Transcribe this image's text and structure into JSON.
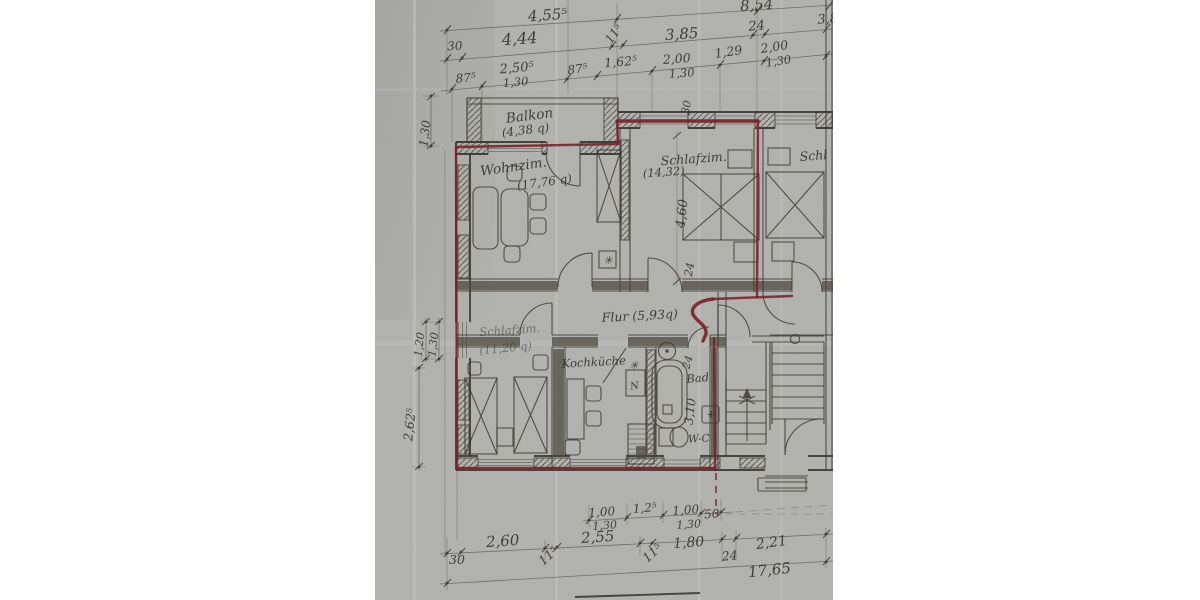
{
  "colors": {
    "paper": "#b3b4b0",
    "pencil": "#3a362f",
    "ink": "#2e2a25",
    "boundary_red": "#7c2024"
  },
  "rooms": {
    "balkon": {
      "name": "Balkon",
      "area": "(4,38 q)"
    },
    "wohnzimmer": {
      "name": "Wohnzim.",
      "area": "(17,76 q)"
    },
    "schlafzimmer_top": {
      "name": "Schlafzim.",
      "area": "(14,32)"
    },
    "schlafzimmer_neighbor": {
      "name": "Schl"
    },
    "flur": {
      "name": "Flur (5,93q)"
    },
    "schlafzimmer_bottom": {
      "name": "Schlafzim.",
      "area": "(11,20 q)"
    },
    "kochkueche": {
      "name": "Kochküche"
    },
    "bad": {
      "name": "Bad"
    },
    "wc": {
      "name": "W-C"
    }
  },
  "dims": {
    "top1_a": "4,55⁵",
    "top1_b": "8,54",
    "top2_a": "30",
    "top2_b": "4,44",
    "top2_c": "11⁵",
    "top2_d": "3,85",
    "top2_e": "24",
    "top2_f": "3,8",
    "top3_a": "87⁵",
    "top3_b": "2,50⁵",
    "top3_b2": "1,30",
    "top3_c": "87⁵",
    "top3_d": "1,62⁵",
    "top3_e": "2,00",
    "top3_e2": "1,30",
    "top3_f": "1,29",
    "top3_g": "2,00",
    "top3_g2": "1,30",
    "left_a": "1,30",
    "left_b": "1,20",
    "left_c": "1,30",
    "left_d": "2,62⁵",
    "in_a": "30",
    "in_b": "4,60",
    "in_c": "24",
    "in_d": "24",
    "in_e": "3,10",
    "bot1_a": "1,00",
    "bot1_a2": "1,30",
    "bot1_b": "1,2⁵",
    "bot1_c": "1,00",
    "bot1_c2": "1,30",
    "bot1_d": "50",
    "bot2_a": "2,60",
    "bot2_b": "11⁵",
    "bot2_c": "2,55",
    "bot2_d": "11⁵",
    "bot2_e": "1,80",
    "bot2_f": "24",
    "bot2_g": "2,21",
    "bot3_a": "30",
    "bot3_b": "17,65"
  },
  "symbols": {
    "stove": "✳",
    "kitchen_mark": "✳",
    "sink": "N",
    "basin": "+"
  }
}
